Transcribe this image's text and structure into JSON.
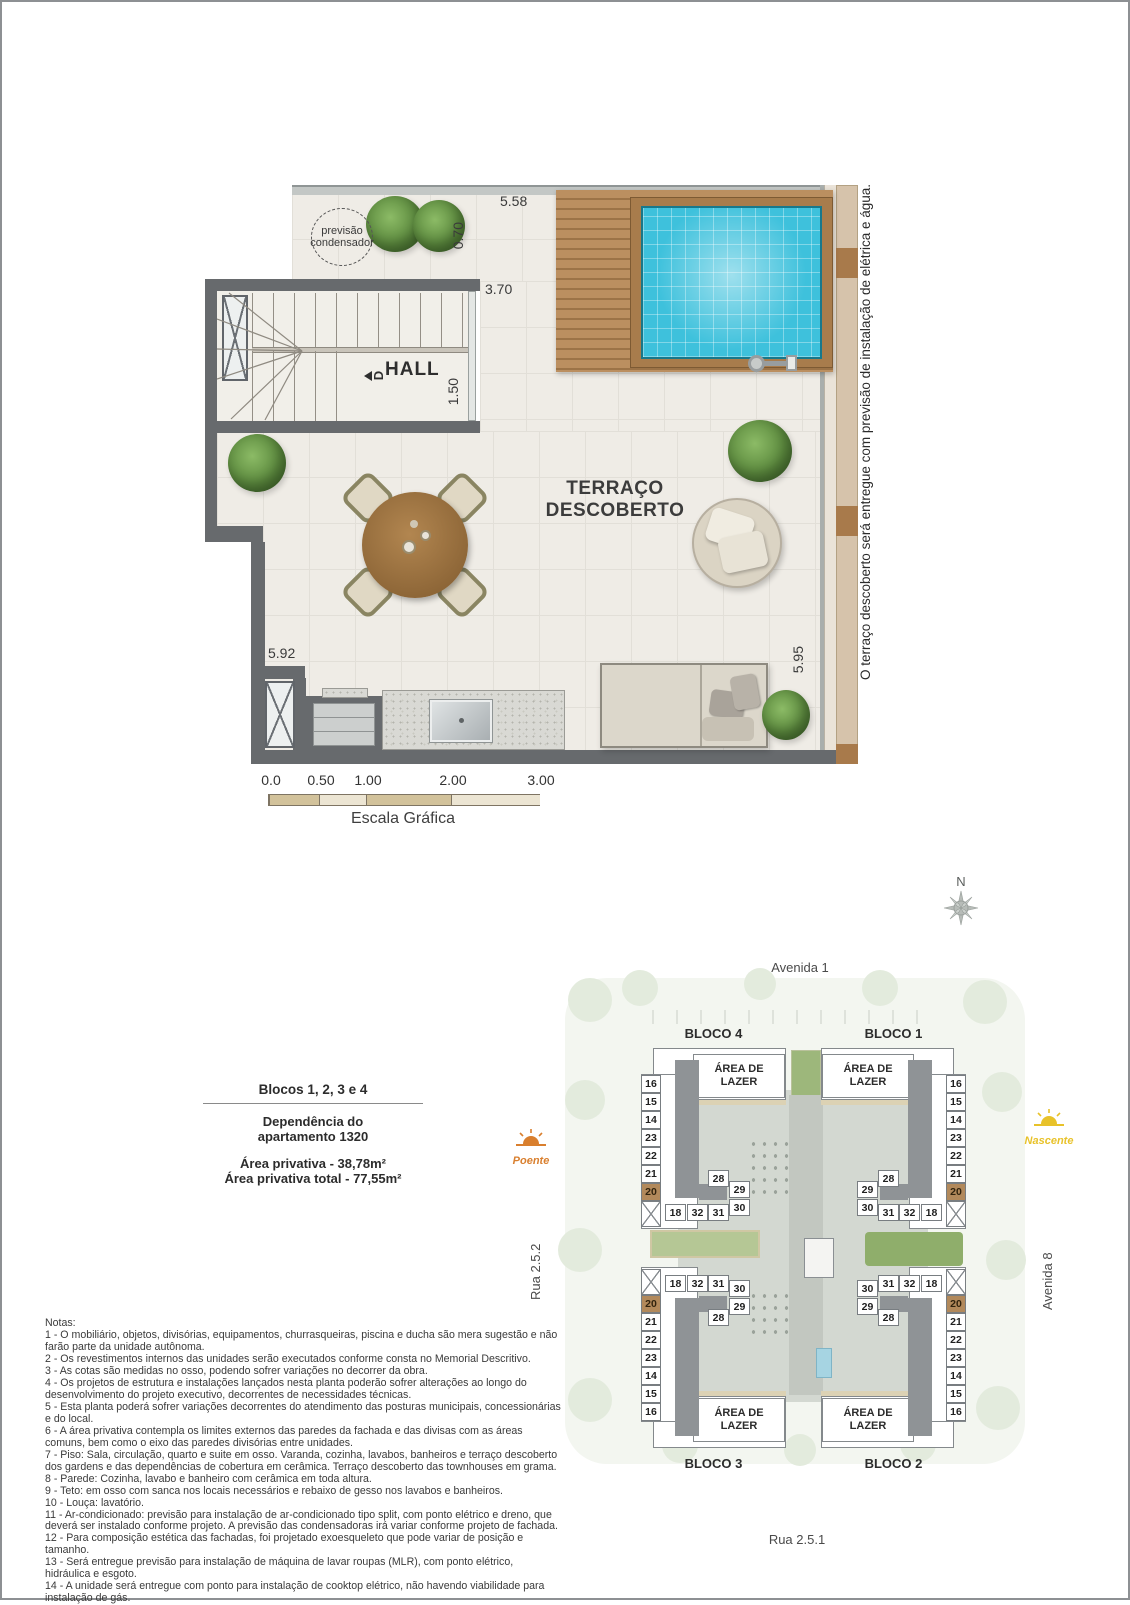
{
  "floor_plan": {
    "condenser": [
      "previsão",
      "condensador"
    ],
    "hall_label": "HALL",
    "stair_direction_label": "D",
    "terrace_label": [
      "TERRAÇO",
      "DESCOBERTO"
    ],
    "dims": {
      "top": "5.58",
      "recess": "0.70",
      "stair": "3.70",
      "hall": "1.50",
      "left": "5.92",
      "right": "5.95"
    },
    "side_note": "O terraço descoberto será entregue com previsão de instalação de elétrica e água.",
    "scale": {
      "ticks": [
        "0.0",
        "0.50",
        "1.00",
        "2.00",
        "3.00"
      ],
      "caption": "Escala Gráfica"
    }
  },
  "compass": {
    "label": "N"
  },
  "info": {
    "title": "Blocos 1, 2, 3 e 4",
    "dep1": "Dependência do",
    "dep2": "apartamento 1320",
    "area1": "Área privativa - 38,78m²",
    "area2": "Área privativa total - 77,55m²"
  },
  "site": {
    "streets": {
      "top": "Avenida 1",
      "right": "Avenida 8",
      "bottom": "Rua 2.5.1",
      "left": "Rua 2.5.2"
    },
    "sun_west": "Poente",
    "sun_east": "Nascente",
    "leisure": [
      "ÁREA DE",
      "LAZER"
    ],
    "highlight": "20",
    "blocks": [
      {
        "label": "BLOCO 4",
        "outer": [
          "16",
          "15",
          "14",
          "23",
          "22",
          "21",
          "20"
        ],
        "inner": [
          "28",
          "29",
          "30",
          "18",
          "32",
          "31"
        ]
      },
      {
        "label": "BLOCO 1",
        "outer": [
          "16",
          "15",
          "14",
          "23",
          "22",
          "21",
          "20"
        ],
        "inner": [
          "28",
          "29",
          "30",
          "18",
          "32",
          "31"
        ]
      },
      {
        "label": "BLOCO 3",
        "outer": [
          "16",
          "15",
          "14",
          "23",
          "22",
          "21",
          "20"
        ],
        "inner": [
          "28",
          "29",
          "30",
          "18",
          "32",
          "31"
        ]
      },
      {
        "label": "BLOCO 2",
        "outer": [
          "16",
          "15",
          "14",
          "23",
          "22",
          "21",
          "20"
        ],
        "inner": [
          "28",
          "29",
          "30",
          "18",
          "32",
          "31"
        ]
      }
    ]
  },
  "notes": {
    "title": "Notas:",
    "items": [
      "1 - O mobiliário, objetos, divisórias, equipamentos, churrasqueiras, piscina e ducha são mera sugestão e não farão parte da unidade autônoma.",
      "2 - Os revestimentos internos das unidades serão executados conforme consta no Memorial Descritivo.",
      "3 - As cotas são medidas no osso, podendo sofrer variações no decorrer da obra.",
      "4 - Os projetos de estrutura e instalações lançados nesta planta poderão sofrer alterações ao longo do desenvolvimento do projeto executivo, decorrentes de necessidades técnicas.",
      "5 - Esta planta poderá sofrer variações decorrentes do atendimento das posturas municipais, concessionárias e do local.",
      "6 - A área privativa contempla os limites externos das paredes da fachada e das divisas com as áreas comuns, bem como o eixo das paredes divisórias entre unidades.",
      "7 - Piso: Sala, circulação, quarto e suite em osso. Varanda, cozinha, lavabos, banheiros e terraço descoberto dos gardens e das dependências de cobertura em cerâmica. Terraço descoberto das townhouses em grama.",
      "8 - Parede: Cozinha, lavabo e banheiro com cerâmica em toda altura.",
      "9 - Teto: em osso com sanca nos locais necessários e rebaixo de gesso nos lavabos e banheiros.",
      "10 - Louça: lavatório.",
      "11 - Ar-condicionado: previsão para instalação de ar-condicionado tipo split, com ponto elétrico e dreno, que deverá ser instalado conforme projeto. A previsão das condensadoras irá variar conforme projeto de fachada.",
      "12 - Para composição estética das fachadas, foi projetado exoesqueleto que pode variar de posição e tamanho.",
      "13 - Será entregue previsão para instalação de máquina de lavar roupas (MLR), com ponto elétrico, hidráulica e esgoto.",
      "14 - A unidade será entregue com ponto para instalação de cooktop elétrico, não havendo viabilidade para instalação de gás."
    ]
  },
  "colors": {
    "wall": "#676a6d",
    "floor": "#efece6",
    "pool_water": "#3ec1dc",
    "deck_wood": "#bb8f60",
    "highlight_unit": "#b2895b",
    "sun_west": "#d97f2e",
    "sun_east": "#e8c22a",
    "site_ground": "#f3f6f0"
  }
}
